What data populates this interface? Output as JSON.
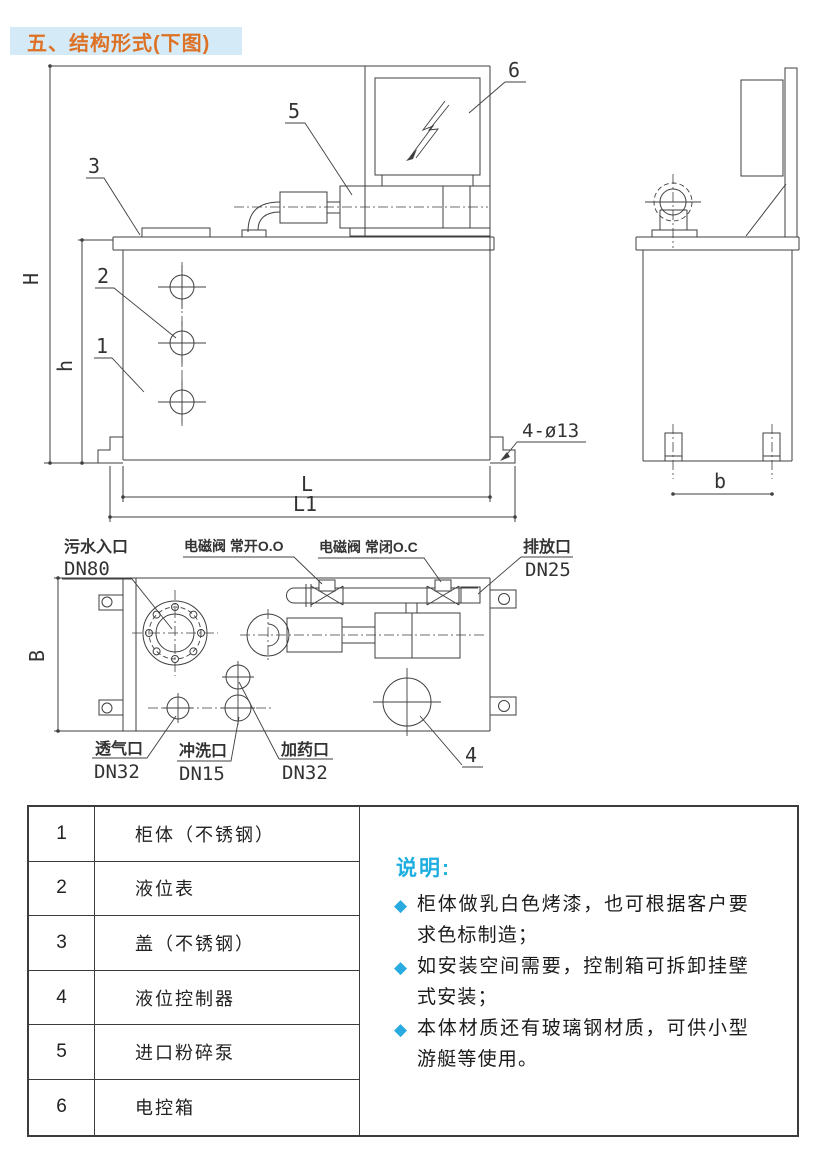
{
  "title": "五、结构形式(下图)",
  "colors": {
    "title_text": "#DD7226",
    "title_bg": "#D4EAF6",
    "notes_heading": "#1FAEE0",
    "bullet": "#29ABE2",
    "drawing_line": "#3F3F3F"
  },
  "drawing": {
    "dimensions": {
      "H": "H",
      "h": "h",
      "L": "L",
      "L1": "L1",
      "b": "b",
      "B": "B",
      "mount_holes": "4-ø13"
    },
    "callouts": {
      "c1": "1",
      "c2": "2",
      "c3": "3",
      "c4": "4",
      "c5": "5",
      "c6": "6"
    },
    "ports": {
      "inlet_name": "污水入口",
      "inlet_dn": "DN80",
      "valve_no": "电磁阀 常开O.O",
      "valve_nc": "电磁阀 常闭O.C",
      "drain_name": "排放口",
      "drain_dn": "DN25",
      "vent_name": "透气口",
      "vent_dn": "DN32",
      "flush_name": "冲洗口",
      "flush_dn": "DN15",
      "dose_name": "加药口",
      "dose_dn": "DN32"
    }
  },
  "parts_table": {
    "rows": [
      {
        "num": "1",
        "name": "柜体（不锈钢）"
      },
      {
        "num": "2",
        "name": "液位表"
      },
      {
        "num": "3",
        "name": "盖（不锈钢）"
      },
      {
        "num": "4",
        "name": "液位控制器"
      },
      {
        "num": "5",
        "name": "进口粉碎泵"
      },
      {
        "num": "6",
        "name": "电控箱"
      }
    ]
  },
  "notes": {
    "heading": "说明:",
    "bullet_glyph": "◆",
    "items": [
      "柜体做乳白色烤漆，也可根据客户要求色标制造；",
      "如安装空间需要，控制箱可拆卸挂壁式安装；",
      "本体材质还有玻璃钢材质，可供小型游艇等使用。"
    ]
  }
}
